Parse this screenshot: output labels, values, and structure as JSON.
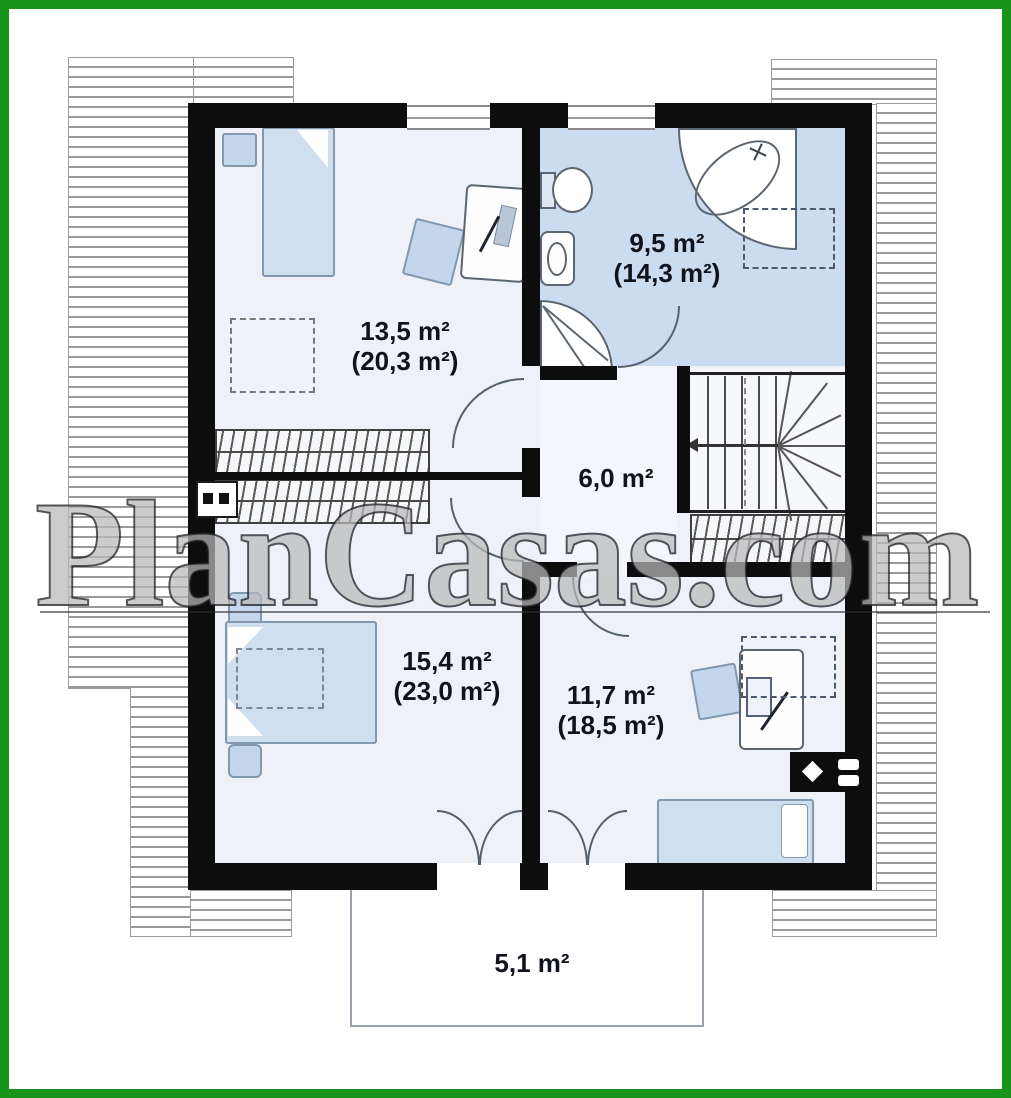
{
  "watermark": {
    "text": "PlanCasas.com"
  },
  "plan": {
    "rooms": [
      {
        "name": "bedroom-top-left",
        "area": "13,5 m²",
        "floor_area": "(20,3 m²)"
      },
      {
        "name": "bathroom",
        "area": "9,5 m²",
        "floor_area": "(14,3 m²)"
      },
      {
        "name": "hall",
        "area": "6,0 m²",
        "floor_area": ""
      },
      {
        "name": "bedroom-bottom-left",
        "area": "15,4 m²",
        "floor_area": "(23,0 m²)"
      },
      {
        "name": "bedroom-bottom-right",
        "area": "11,7 m²",
        "floor_area": "(18,5 m²)"
      },
      {
        "name": "balcony",
        "area": "5,1 m²",
        "floor_area": ""
      }
    ]
  },
  "colors": {
    "frame_green": "#18941a",
    "wall_black": "#0d0d0d",
    "room_fill": "#eef2f8",
    "bathroom_fill": "#cbdcf0",
    "furniture_blue": "#c3d6eb",
    "hatch_line": "#9a9a9a",
    "label_text": "#10131c"
  }
}
